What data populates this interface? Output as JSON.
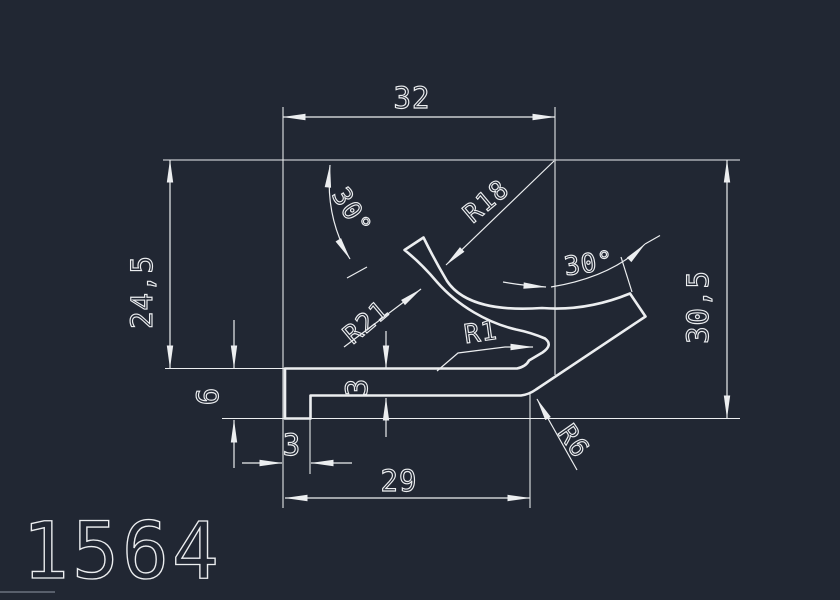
{
  "drawing": {
    "part_number": "1564",
    "colors": {
      "bg-color": "#212733",
      "line-color": "#eceef0",
      "faint-color": "#6b7280"
    },
    "dimensions": {
      "top_width": "32",
      "left_height": "24,5",
      "right_height": "30,5",
      "foot_height": "6",
      "foot_width": "3",
      "base_thickness": "3",
      "base_length": "29"
    },
    "angles": {
      "left": "30°",
      "right": "30°"
    },
    "radii": {
      "arm_outer": "R18",
      "arm_inner": "R21",
      "lip": "R1",
      "heel": "R6"
    }
  }
}
